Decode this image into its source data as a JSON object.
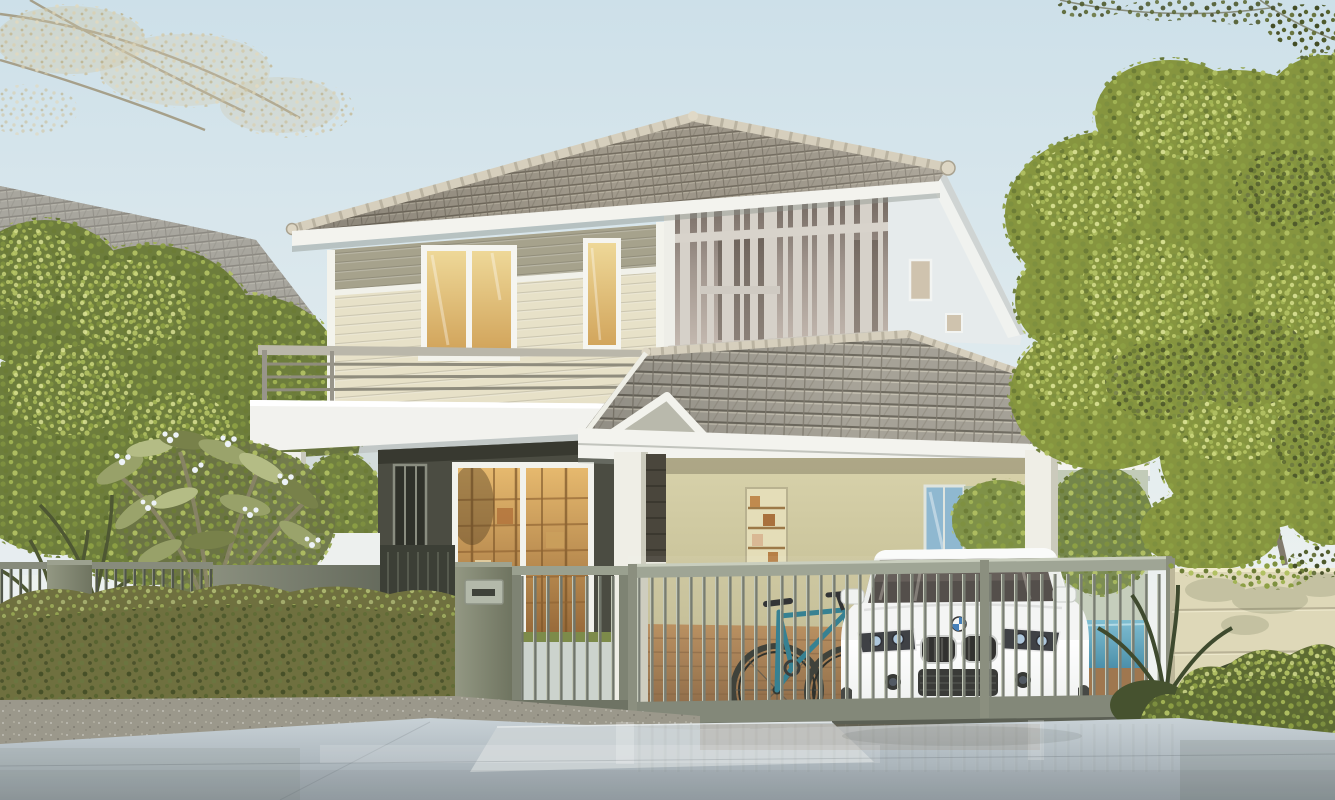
{
  "meta": {
    "title": "Modern two-storey suburban house with carport, white SUV and sliding gate — photorealistic 3D architectural rendering",
    "type": "3d-architectural-rendering",
    "dimensions": "1335x800",
    "time_of_day": "daytime, soft sunlight from the left"
  },
  "objects": {
    "sky": {
      "label": "pale blue gradient sky"
    },
    "overhanging_branches": {
      "label": "faded tree branch overhanging top-left corner; dark leaf sprigs at top-right edge"
    },
    "neighbor_house": {
      "label": "white neighbouring house with grey hip tile roof, partially hidden by a garden tree"
    },
    "main_house": {
      "label": "two-storey modern house, hip tile roofs, cream and olive lap siding, dark accent walls",
      "storeys": 2
    },
    "slat_screen": {
      "label": "decorative vertical slat screen on upper floor right wing"
    },
    "balcony": {
      "label": "first-floor balcony with metal rail above entrance porch"
    },
    "windows": {
      "label": "warm-lit casement and tall windows on upper floor"
    },
    "entrance": {
      "label": "glass sliding door with warm-lit bookshelves inside, dark feature wall, small white gable canopy"
    },
    "carport": {
      "label": "attached carport under large sloping tile roof with white columns"
    },
    "bookshelf_niche": {
      "label": "recessed wooden bookshelf niche in carport wall"
    },
    "vehicle": {
      "label": "white luxury SUV with twin kidney grille and blue-white roundel badge",
      "color": "white"
    },
    "bicycle": {
      "label": "teal mountain bike leaning inside carport",
      "color": "teal"
    },
    "front_fence": {
      "label": "olive-grey metal fence: vertical bar sections, solid panels and pillars"
    },
    "pedestrian_gate": {
      "label": "barred pedestrian gate beside mailbox pillar"
    },
    "sliding_gate": {
      "label": "long vertical-bar sliding driveway gate in front of the carport"
    },
    "mailbox": {
      "label": "metal mailbox plate with letter slot on gate pillar"
    },
    "boundary_wall": {
      "label": "cream rendered boundary wall with horizontal grooves on the right"
    },
    "hedge": {
      "label": "low clipped olive hedge along the left fence"
    },
    "shrubs": {
      "label": "bright green shrubs in front of the right wall"
    },
    "plumeria": {
      "label": "frangipani bush with white blossoms behind the fence"
    },
    "garden_trees": {
      "label": "large yellow-green leafy tree on the right, green tree on the left"
    },
    "pool_hint": {
      "label": "glimpse of blue water feature in the backyard behind the gate"
    },
    "driveway": {
      "label": "polished concrete driveway with soft reflections"
    }
  },
  "palette": {
    "sky_top": "#cde0e9",
    "sky_horizon": "#f0f3f1",
    "roof_tile": "#a19a8c",
    "roof_line": "#746d60",
    "ridge_cap": "#d6cfbd",
    "fascia_white": "#f3f3ee",
    "siding_cream": "#e7e1c8",
    "siding_olive": "#a6a28c",
    "screen_slat": "#d6d1c9",
    "screen_bg": "#8a7e76",
    "window_glow": "#e3c27c",
    "feature_wall_dark": "#4b4c42",
    "carport_wall": "#cfc9a0",
    "floor_wood": "#a87f52",
    "fence_metal": "#7c8171",
    "gate_bar_light": "#a7ac9c",
    "gate_bar_dark": "#70756a",
    "mailbox_plate": "#b3b9aa",
    "wall_cream": "#ded8b8",
    "driveway_grey": "#aeb8be",
    "hedge_green": "#6f703f",
    "tree_green": "#86953f",
    "tree_highlight": "#bcc968",
    "car_body": "#f4f5f4",
    "car_glass": "#4a4440",
    "bike_teal": "#2b7a8c",
    "pool_blue": "#4e9ab5"
  }
}
